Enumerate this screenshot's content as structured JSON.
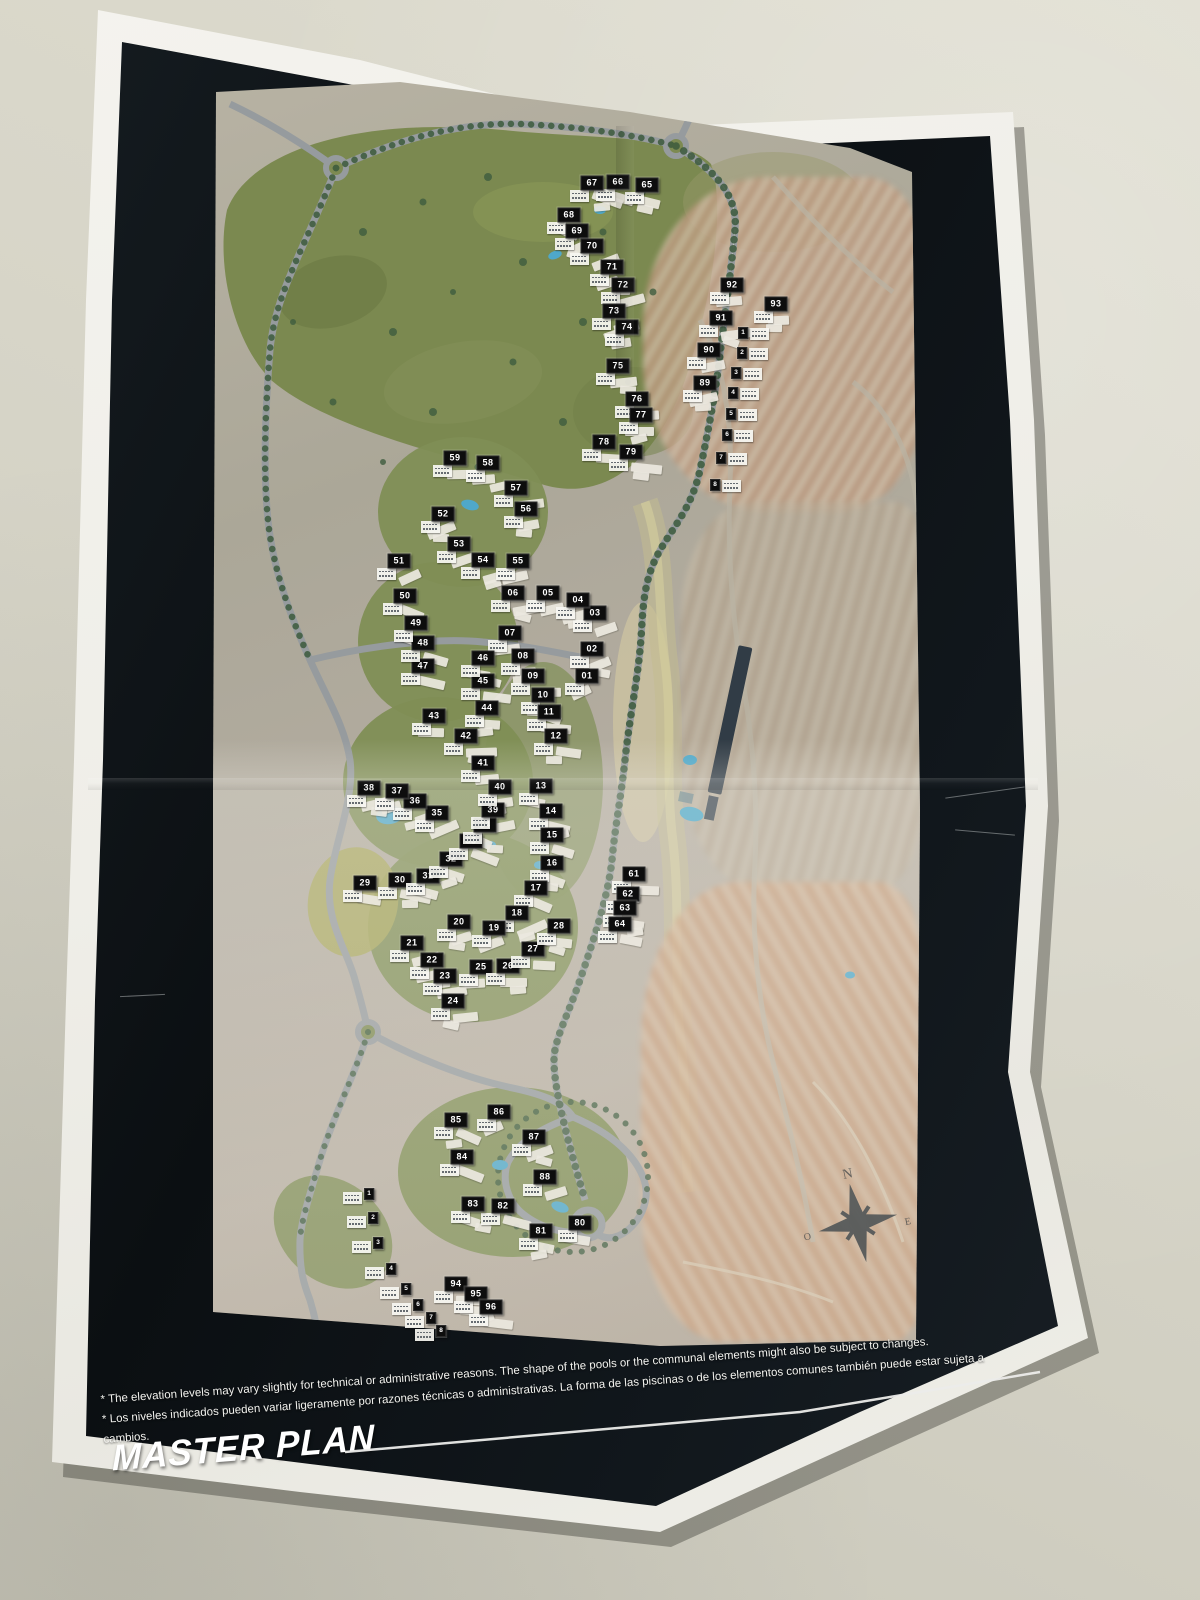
{
  "poster": {
    "title": "MASTER PLAN",
    "disclaimers": [
      "* The elevation levels may vary slightly for technical or administrative reasons. The shape of the pools or the communal elements might also be subject to changes.",
      "* Los niveles indicados pueden variar ligeramente por razones técnicas o administrativas. La forma de las piscinas o de los elementos comunes también puede estar sujeta a cambios."
    ]
  },
  "compass": {
    "n": "N",
    "o": "O",
    "e": "E"
  },
  "colors": {
    "wall": "#d8d6c9",
    "paper": "#f1f0ea",
    "plate": "#10161b",
    "label_bg": "#0d0d0d",
    "label_fg": "#ffffff",
    "green": "#7b8950",
    "road": "#989da0",
    "pool": "#4fa8c9",
    "terra": "#c39b79"
  },
  "map": {
    "blocks": [
      {
        "n": "01",
        "x": 587,
        "y": 676
      },
      {
        "n": "02",
        "x": 592,
        "y": 649
      },
      {
        "n": "03",
        "x": 595,
        "y": 613
      },
      {
        "n": "04",
        "x": 578,
        "y": 600
      },
      {
        "n": "05",
        "x": 548,
        "y": 593
      },
      {
        "n": "06",
        "x": 513,
        "y": 593
      },
      {
        "n": "07",
        "x": 510,
        "y": 633
      },
      {
        "n": "08",
        "x": 523,
        "y": 656
      },
      {
        "n": "09",
        "x": 533,
        "y": 676
      },
      {
        "n": "10",
        "x": 543,
        "y": 695
      },
      {
        "n": "11",
        "x": 549,
        "y": 712
      },
      {
        "n": "12",
        "x": 556,
        "y": 736
      },
      {
        "n": "13",
        "x": 541,
        "y": 786
      },
      {
        "n": "14",
        "x": 551,
        "y": 811
      },
      {
        "n": "15",
        "x": 552,
        "y": 835
      },
      {
        "n": "16",
        "x": 552,
        "y": 863
      },
      {
        "n": "17",
        "x": 536,
        "y": 888
      },
      {
        "n": "18",
        "x": 517,
        "y": 913
      },
      {
        "n": "19",
        "x": 494,
        "y": 928
      },
      {
        "n": "20",
        "x": 459,
        "y": 922
      },
      {
        "n": "21",
        "x": 412,
        "y": 943
      },
      {
        "n": "22",
        "x": 432,
        "y": 960
      },
      {
        "n": "23",
        "x": 445,
        "y": 976
      },
      {
        "n": "24",
        "x": 453,
        "y": 1001
      },
      {
        "n": "25",
        "x": 481,
        "y": 967
      },
      {
        "n": "26",
        "x": 508,
        "y": 966
      },
      {
        "n": "27",
        "x": 533,
        "y": 949
      },
      {
        "n": "28",
        "x": 559,
        "y": 926
      },
      {
        "n": "29",
        "x": 365,
        "y": 883
      },
      {
        "n": "30",
        "x": 400,
        "y": 880
      },
      {
        "n": "31",
        "x": 428,
        "y": 876
      },
      {
        "n": "32",
        "x": 451,
        "y": 859
      },
      {
        "n": "33",
        "x": 471,
        "y": 841
      },
      {
        "n": "34",
        "x": 485,
        "y": 825
      },
      {
        "n": "35",
        "x": 437,
        "y": 813
      },
      {
        "n": "36",
        "x": 415,
        "y": 801
      },
      {
        "n": "37",
        "x": 397,
        "y": 791
      },
      {
        "n": "38",
        "x": 369,
        "y": 788
      },
      {
        "n": "39",
        "x": 493,
        "y": 810
      },
      {
        "n": "40",
        "x": 500,
        "y": 787
      },
      {
        "n": "41",
        "x": 483,
        "y": 763
      },
      {
        "n": "42",
        "x": 466,
        "y": 736
      },
      {
        "n": "43",
        "x": 434,
        "y": 716
      },
      {
        "n": "44",
        "x": 487,
        "y": 708
      },
      {
        "n": "45",
        "x": 483,
        "y": 681
      },
      {
        "n": "46",
        "x": 483,
        "y": 658
      },
      {
        "n": "47",
        "x": 423,
        "y": 666
      },
      {
        "n": "48",
        "x": 423,
        "y": 643
      },
      {
        "n": "49",
        "x": 416,
        "y": 623
      },
      {
        "n": "50",
        "x": 405,
        "y": 596
      },
      {
        "n": "51",
        "x": 399,
        "y": 561
      },
      {
        "n": "52",
        "x": 443,
        "y": 514
      },
      {
        "n": "53",
        "x": 459,
        "y": 544
      },
      {
        "n": "54",
        "x": 483,
        "y": 560
      },
      {
        "n": "55",
        "x": 518,
        "y": 561
      },
      {
        "n": "56",
        "x": 526,
        "y": 509
      },
      {
        "n": "57",
        "x": 516,
        "y": 488
      },
      {
        "n": "58",
        "x": 488,
        "y": 463
      },
      {
        "n": "59",
        "x": 455,
        "y": 458
      },
      {
        "n": "61",
        "x": 634,
        "y": 874
      },
      {
        "n": "62",
        "x": 628,
        "y": 894
      },
      {
        "n": "63",
        "x": 625,
        "y": 908
      },
      {
        "n": "64",
        "x": 620,
        "y": 924
      },
      {
        "n": "65",
        "x": 647,
        "y": 185
      },
      {
        "n": "66",
        "x": 618,
        "y": 182
      },
      {
        "n": "67",
        "x": 592,
        "y": 183
      },
      {
        "n": "68",
        "x": 569,
        "y": 215
      },
      {
        "n": "69",
        "x": 577,
        "y": 231
      },
      {
        "n": "70",
        "x": 592,
        "y": 246
      },
      {
        "n": "71",
        "x": 612,
        "y": 267
      },
      {
        "n": "72",
        "x": 623,
        "y": 285
      },
      {
        "n": "73",
        "x": 614,
        "y": 311
      },
      {
        "n": "74",
        "x": 627,
        "y": 327
      },
      {
        "n": "75",
        "x": 618,
        "y": 366
      },
      {
        "n": "76",
        "x": 637,
        "y": 399
      },
      {
        "n": "77",
        "x": 641,
        "y": 415
      },
      {
        "n": "78",
        "x": 604,
        "y": 442
      },
      {
        "n": "79",
        "x": 631,
        "y": 452
      },
      {
        "n": "80",
        "x": 580,
        "y": 1223
      },
      {
        "n": "81",
        "x": 541,
        "y": 1231
      },
      {
        "n": "82",
        "x": 503,
        "y": 1206
      },
      {
        "n": "83",
        "x": 473,
        "y": 1204
      },
      {
        "n": "84",
        "x": 462,
        "y": 1157
      },
      {
        "n": "85",
        "x": 456,
        "y": 1120
      },
      {
        "n": "86",
        "x": 499,
        "y": 1112
      },
      {
        "n": "87",
        "x": 534,
        "y": 1137
      },
      {
        "n": "88",
        "x": 545,
        "y": 1177
      },
      {
        "n": "89",
        "x": 705,
        "y": 383
      },
      {
        "n": "90",
        "x": 709,
        "y": 350
      },
      {
        "n": "91",
        "x": 721,
        "y": 318
      },
      {
        "n": "92",
        "x": 732,
        "y": 285
      },
      {
        "n": "93",
        "x": 776,
        "y": 304
      },
      {
        "n": "94",
        "x": 456,
        "y": 1284
      },
      {
        "n": "95",
        "x": 476,
        "y": 1294
      },
      {
        "n": "96",
        "x": 491,
        "y": 1307
      }
    ],
    "villas_right": [
      {
        "n": "1",
        "x": 743,
        "y": 333
      },
      {
        "n": "2",
        "x": 742,
        "y": 353
      },
      {
        "n": "3",
        "x": 736,
        "y": 373
      },
      {
        "n": "4",
        "x": 733,
        "y": 393
      },
      {
        "n": "5",
        "x": 731,
        "y": 414
      },
      {
        "n": "6",
        "x": 727,
        "y": 435
      },
      {
        "n": "7",
        "x": 721,
        "y": 458
      },
      {
        "n": "8",
        "x": 715,
        "y": 485
      }
    ],
    "villas_left": [
      {
        "n": "1",
        "x": 369,
        "y": 1194
      },
      {
        "n": "2",
        "x": 373,
        "y": 1218
      },
      {
        "n": "3",
        "x": 378,
        "y": 1243
      },
      {
        "n": "4",
        "x": 391,
        "y": 1269
      },
      {
        "n": "5",
        "x": 406,
        "y": 1289
      },
      {
        "n": "6",
        "x": 418,
        "y": 1305
      },
      {
        "n": "7",
        "x": 431,
        "y": 1318
      },
      {
        "n": "8",
        "x": 441,
        "y": 1331
      }
    ]
  }
}
